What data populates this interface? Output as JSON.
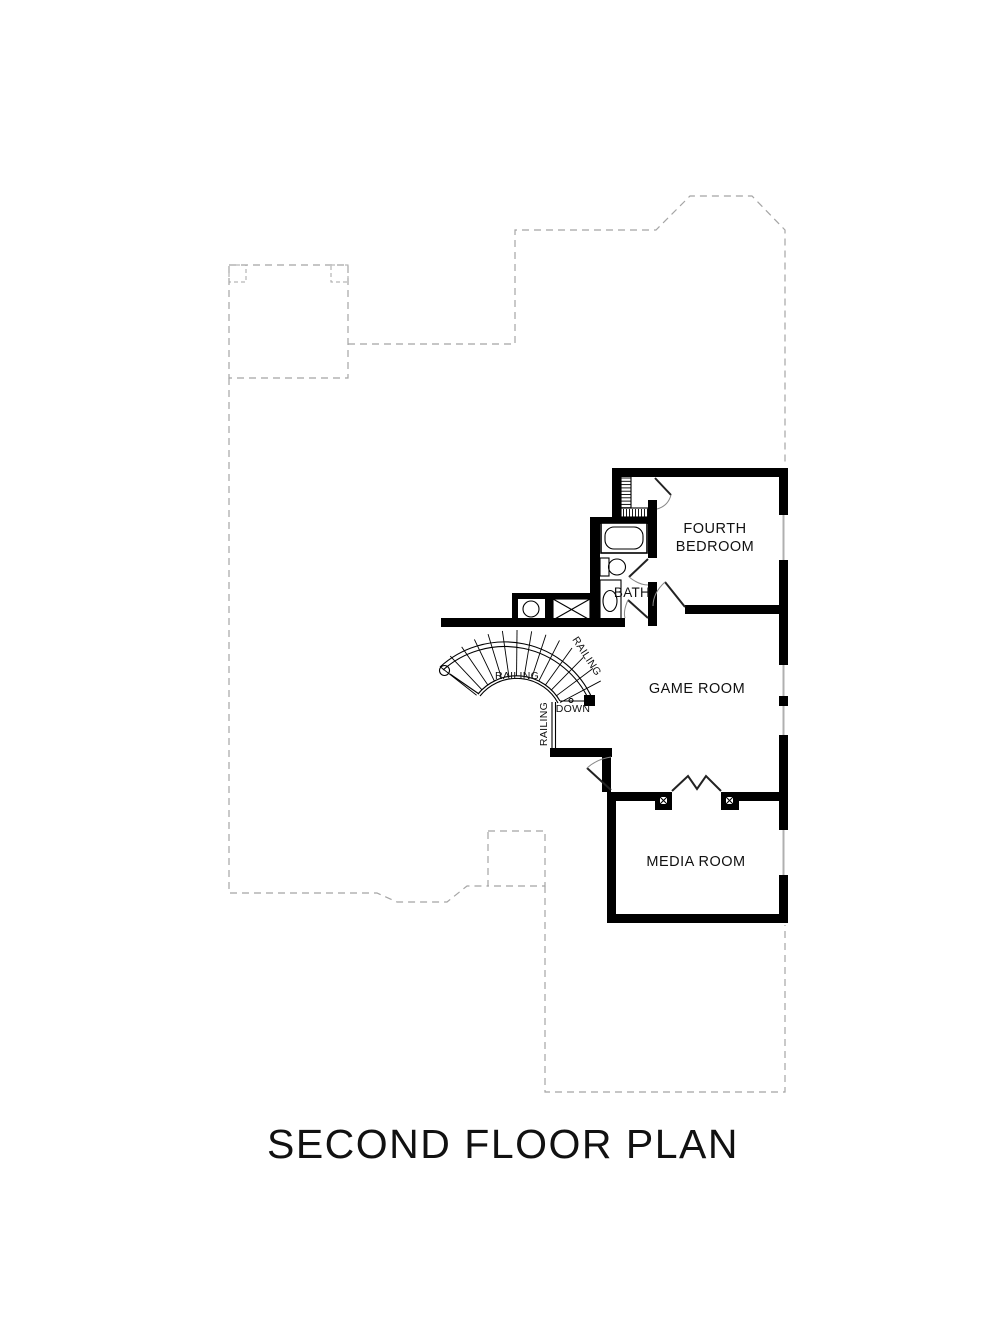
{
  "title": "SECOND FLOOR PLAN",
  "rooms": {
    "fourth_bedroom": {
      "line1": "FOURTH",
      "line2": "BEDROOM"
    },
    "bath": {
      "label": "BATH"
    },
    "game_room": {
      "label": "GAME ROOM"
    },
    "media_room": {
      "label": "MEDIA ROOM"
    }
  },
  "stairs": {
    "down": "DOWN",
    "railing_inner": "RAILING",
    "railing_outer": "RAILING",
    "railing_lower": "RAILING"
  },
  "colors": {
    "walls": "#000000",
    "dashed_outline": "#a5a5a5",
    "background": "#ffffff",
    "text": "#111111"
  }
}
